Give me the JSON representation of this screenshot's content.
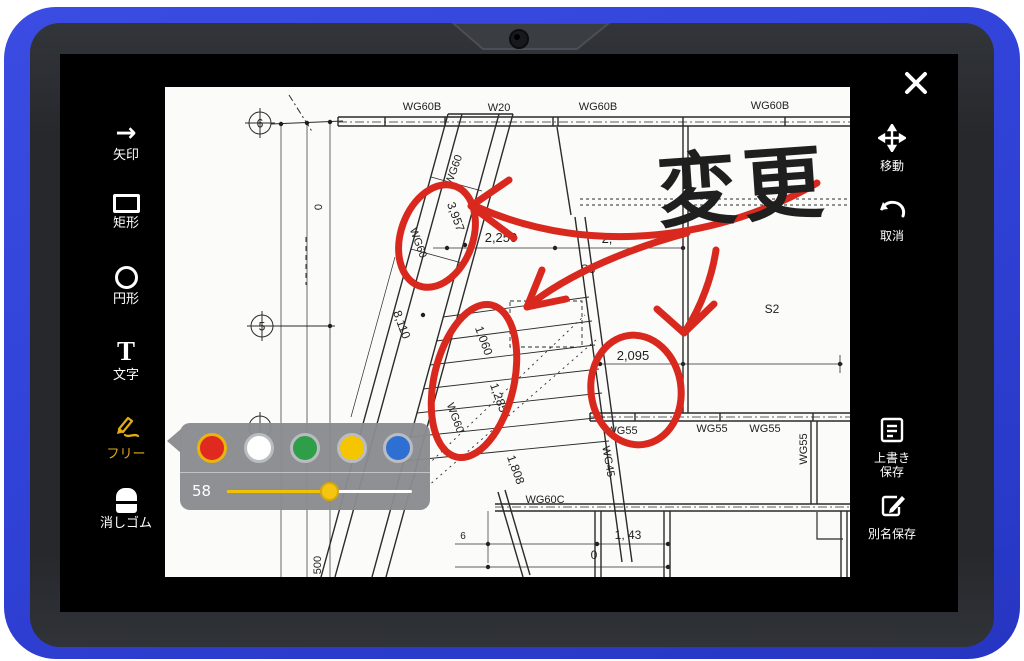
{
  "app": {
    "name": "drawing-markup"
  },
  "toolbar_left": {
    "items": [
      {
        "id": "arrow",
        "icon": "arrow-right-icon",
        "glyph": "→",
        "label": "矢印",
        "active": false
      },
      {
        "id": "rect",
        "icon": "rectangle-icon",
        "label": "矩形",
        "active": false
      },
      {
        "id": "circle",
        "icon": "circle-icon",
        "label": "円形",
        "active": false
      },
      {
        "id": "text",
        "icon": "text-icon",
        "glyph": "T",
        "label": "文字",
        "active": false
      },
      {
        "id": "free",
        "icon": "pencil-icon",
        "label": "フリー",
        "active": true
      },
      {
        "id": "eraser",
        "icon": "eraser-icon",
        "label": "消しゴム",
        "active": false
      }
    ]
  },
  "toolbar_right": {
    "close_icon": "close-icon",
    "items": [
      {
        "id": "move",
        "icon": "move-icon",
        "label": "移動"
      },
      {
        "id": "undo",
        "icon": "undo-icon",
        "glyph": "↶",
        "label": "取消"
      },
      {
        "id": "save",
        "icon": "save-doc-icon",
        "label_line1": "上書き",
        "label_line2": "保存"
      },
      {
        "id": "save_as",
        "icon": "save-as-icon",
        "label": "別名保存"
      }
    ]
  },
  "color_popup": {
    "colors": [
      {
        "name": "red",
        "hex": "#e02a1f",
        "selected": true
      },
      {
        "name": "white",
        "hex": "#ffffff",
        "selected": false
      },
      {
        "name": "green",
        "hex": "#2f9e49",
        "selected": false
      },
      {
        "name": "yellow",
        "hex": "#f5c500",
        "selected": false
      },
      {
        "name": "blue",
        "hex": "#2e6fd3",
        "selected": false
      }
    ],
    "slider": {
      "value": "58",
      "percent": 55
    }
  },
  "annotation": {
    "note": "変更",
    "color": "#d9281e"
  },
  "blueprint": {
    "grid_bubbles": [
      {
        "t": "6",
        "x": 95,
        "y": 36
      },
      {
        "t": "5",
        "x": 97,
        "y": 239
      }
    ],
    "labels": [
      {
        "t": "WG60B",
        "x": 257,
        "y": 23,
        "s": 11
      },
      {
        "t": "W20",
        "x": 334,
        "y": 24,
        "s": 11
      },
      {
        "t": "WG60B",
        "x": 433,
        "y": 23,
        "s": 11
      },
      {
        "t": "WG60B",
        "x": 605,
        "y": 22,
        "s": 11
      },
      {
        "t": "WG60",
        "x": 292,
        "y": 84,
        "r": -70,
        "s": 11
      },
      {
        "t": "3,957",
        "x": 287,
        "y": 131,
        "r": 70,
        "s": 12
      },
      {
        "t": "WG60",
        "x": 250,
        "y": 157,
        "r": 70,
        "s": 11
      },
      {
        "t": "2,250",
        "x": 336,
        "y": 155,
        "s": 13
      },
      {
        "t": "2,",
        "x": 442,
        "y": 156,
        "s": 13
      },
      {
        "t": "S3",
        "x": 423,
        "y": 186,
        "s": 12
      },
      {
        "t": "0",
        "x": 157,
        "y": 120,
        "r": -90,
        "s": 11
      },
      {
        "t": "8,110",
        "x": 233,
        "y": 239,
        "r": 70,
        "s": 12
      },
      {
        "t": "1,060",
        "x": 315,
        "y": 255,
        "r": 70,
        "s": 12
      },
      {
        "t": "1,285",
        "x": 330,
        "y": 312,
        "r": 70,
        "s": 12
      },
      {
        "t": "WG60",
        "x": 287,
        "y": 332,
        "r": 70,
        "s": 11
      },
      {
        "t": "2,095",
        "x": 468,
        "y": 273,
        "s": 13
      },
      {
        "t": "WG55",
        "x": 457,
        "y": 347,
        "s": 11
      },
      {
        "t": "WG55",
        "x": 547,
        "y": 345,
        "s": 11
      },
      {
        "t": "WG55",
        "x": 600,
        "y": 345,
        "s": 11
      },
      {
        "t": "WG55",
        "x": 642,
        "y": 362,
        "r": -90,
        "s": 11
      },
      {
        "t": "WG45",
        "x": 440,
        "y": 375,
        "r": 80,
        "s": 11
      },
      {
        "t": "1,808",
        "x": 347,
        "y": 384,
        "r": 70,
        "s": 12
      },
      {
        "t": "WG60C",
        "x": 380,
        "y": 416,
        "s": 11
      },
      {
        "t": "S2",
        "x": 607,
        "y": 226,
        "s": 12
      },
      {
        "t": "1, 43",
        "x": 463,
        "y": 452,
        "s": 12
      },
      {
        "t": "0",
        "x": 429,
        "y": 472,
        "s": 12
      },
      {
        "t": "6",
        "x": 298,
        "y": 452,
        "s": 10
      },
      {
        "t": "500",
        "x": 156,
        "y": 478,
        "r": -90,
        "s": 11
      }
    ]
  }
}
